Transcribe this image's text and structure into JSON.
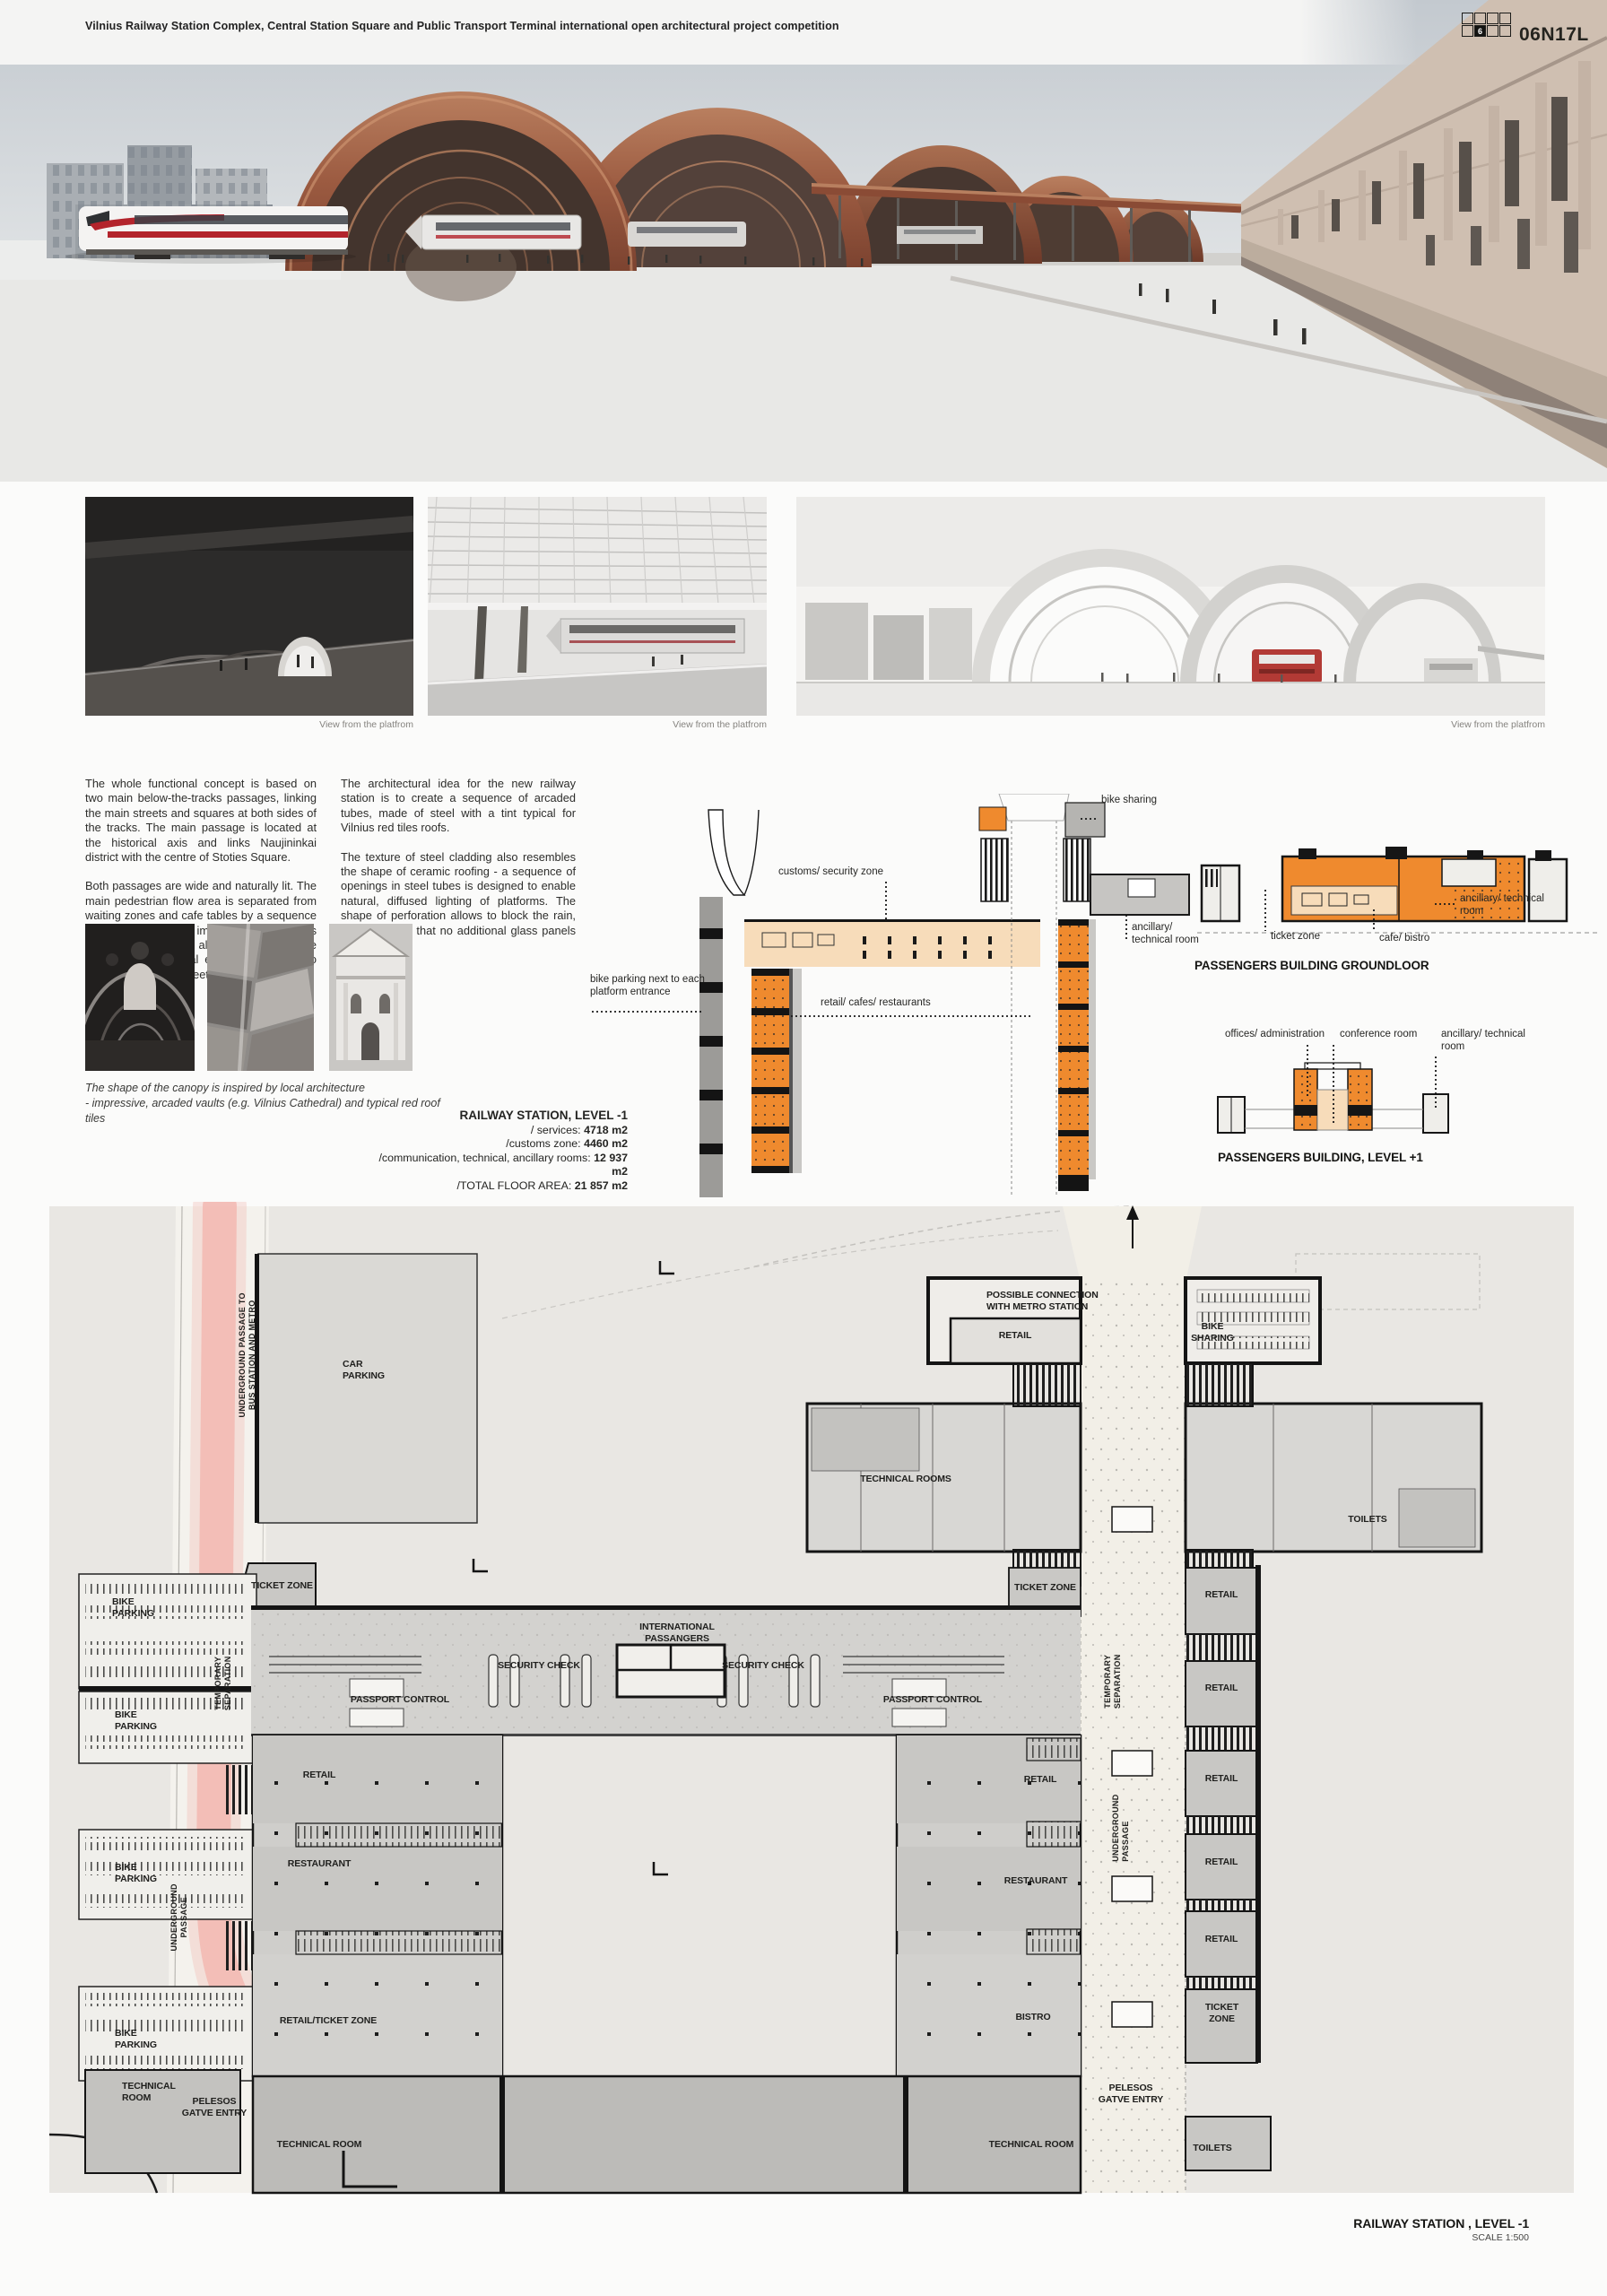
{
  "header": {
    "title": "Vilnius Railway Station Complex, Central Station Square and Public Transport Terminal international open architectural project competition",
    "code": "06N17L",
    "code_cell": "6"
  },
  "captions": {
    "platform_view": "View from the platfrom"
  },
  "concept": {
    "col1_p1": "The whole functional concept is based on two main  below-the-tracks passages, linking the main streets and squares at both sides of the tracks. The main passage is located at the historical axis and links Naujininkai district  with the centre of Stoties Square.",
    "col1_p2": "Both passages are wide and naturally lit. The main pedestrian flow area is separated from waiting zones and cafe tables by a sequence of pillars, forming an image of arcades. This composition not only allows to minimize the size of constructional elements but also to form an attractive, street-like impression.",
    "col2_p1": "The architectural idea for the new railway station is to create a sequence of arcaded tubes, made of steel with a tint typical for Vilnius red tiles roofs.",
    "col2_p2": "The texture of steel cladding also resembles the shape of ceramic roofing - a sequence of openings in steel tubes is designed to enable natural, diffused lighting of platforms. The shape of perforation allows to block the rain, and thanks to that no additional glass panels are required."
  },
  "inspiration": {
    "line1": "The shape of the canopy is inspired by local architecture",
    "line2": "- impressive, arcaded vaults (e.g. Vilnius Cathedral) and typical red roof tiles"
  },
  "summary": {
    "title": "RAILWAY STATION, LEVEL -1",
    "rows": [
      {
        "label": "/ services:",
        "value": "4718 m2"
      },
      {
        "label": "/customs zone:",
        "value": "4460 m2"
      },
      {
        "label": "/communication, technical, ancillary rooms:",
        "value": "12 937 m2"
      },
      {
        "label": "/TOTAL FLOOR AREA:",
        "value": "21 857 m2"
      }
    ]
  },
  "section": {
    "bike_sharing": "bike sharing",
    "customs_zone": "customs/ security zone",
    "ancillary": "ancillary/ technical room",
    "bike_parking": "bike parking next to each platform entrance",
    "retail": "retail/ cafes/ restaurants"
  },
  "groundfloor": {
    "title": "PASSENGERS BUILDING GROUNDLOOR",
    "ancillary": "ancillary/ technical room",
    "ticket_zone": "ticket zone",
    "cafe_bistro": "cafe/ bistro"
  },
  "level1": {
    "title": "PASSENGERS BUILDING, LEVEL +1",
    "offices": "offices/ administration",
    "conference": "conference room",
    "ancillary": "ancillary/ technical room"
  },
  "floorplan": {
    "title": "RAILWAY STATION , LEVEL -1",
    "scale": "SCALE 1:500",
    "labels": {
      "possible_connection": "POSSIBLE CONNECTION WITH METRO STATION",
      "retail": "RETAIL",
      "bike_sharing": "BIKE SHARING",
      "car_parking": "CAR PARKING",
      "underground_to_bus": "UNDERGROUND PASSAGE TO BUS STATION AND METRO",
      "technical_rooms": "TECHNICAL ROOMS",
      "toilets": "TOILETS",
      "ticket_zone": "TICKET ZONE",
      "bike_parking": "BIKE PARKING",
      "international_passangers": "INTERNATIONAL PASSANGERS",
      "security_check": "SECURITY CHECK",
      "temporary_separation": "TEMPORARY SEPARATION",
      "passport_control": "PASSPORT CONTROL",
      "restaurant": "RESTAURANT",
      "underground_passage": "UNDERGROUND PASSAGE",
      "retail_ticket_zone": "RETAIL/TICKET ZONE",
      "bistro": "BISTRO",
      "technical_room": "TECHNICAL ROOM",
      "pelesos_entry": "PELESOS GATVE ENTRY"
    }
  },
  "colors": {
    "accent_orange": "#ef8a2e",
    "beige_band": "#f7dcba",
    "copper": "#9c5b41",
    "pink_passage": "#f2b9b1"
  }
}
